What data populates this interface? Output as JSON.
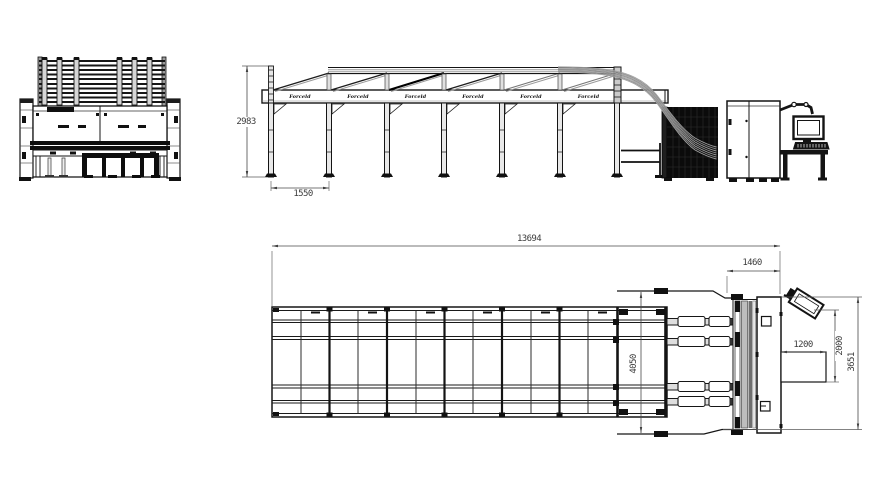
{
  "drawing": {
    "brand": {
      "plate_label": "Forceld"
    },
    "dims": {
      "frame_height": "2983",
      "bay_width": "1550",
      "total_length": "13694",
      "outfeed_length": "1460",
      "bed_width": "4050",
      "console_width": "1200",
      "console_depth": "2000",
      "machine_width": "3651"
    },
    "colors": {
      "line": "#161616",
      "gray": "#9a9a9a",
      "dark_fill": "#0b0b0b",
      "dim_text": "#3c3c3c",
      "background": "#ffffff"
    }
  }
}
